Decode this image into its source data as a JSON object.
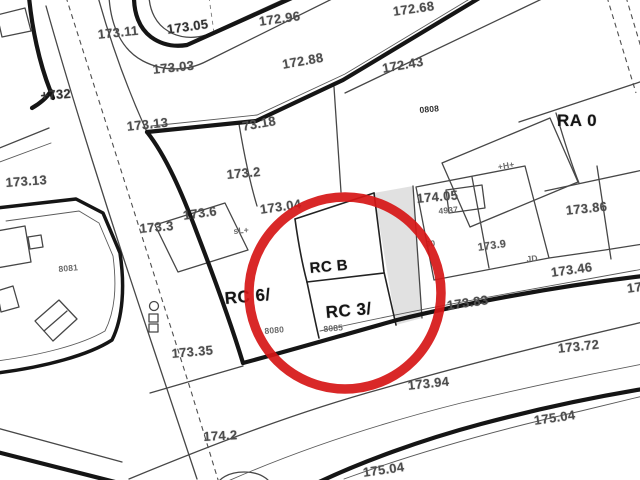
{
  "map": {
    "colors": {
      "background": "#ffffff",
      "thin_lines": "#474747",
      "bold_lines": "#151515",
      "highlight_circle": "#d61616",
      "elevation_text": "#4d4d4d",
      "zone_text": "#141414"
    },
    "highlight": {
      "shape": "circle",
      "cx": 345,
      "cy": 293,
      "r": 96,
      "stroke_width": 9.5
    },
    "zone_codes": [
      "RA 0",
      "RC 6/",
      "RC B",
      "RC 3/"
    ],
    "parcel_numbers": [
      "0808",
      "4937",
      "8080",
      "8081",
      "8085"
    ],
    "labels": [
      {
        "name": "elev-173-11",
        "text": "173.11",
        "x": 97,
        "y": 27,
        "rot": -6,
        "cls": "e"
      },
      {
        "name": "elev-173-05",
        "text": "173.05",
        "x": 166,
        "y": 22,
        "rot": -8,
        "cls": "ed"
      },
      {
        "name": "elev-172-96",
        "text": "172.96",
        "x": 258,
        "y": 14,
        "rot": -8,
        "cls": "e"
      },
      {
        "name": "elev-172-68",
        "text": "172.68",
        "x": 392,
        "y": 4,
        "rot": -8,
        "cls": "e"
      },
      {
        "name": "elev-172-88",
        "text": "172.88",
        "x": 281,
        "y": 57,
        "rot": -10,
        "cls": "e"
      },
      {
        "name": "elev-172-43",
        "text": "172.43",
        "x": 381,
        "y": 61,
        "rot": -10,
        "cls": "e"
      },
      {
        "name": "elev-173-03",
        "text": "173.03",
        "x": 152,
        "y": 62,
        "rot": -6,
        "cls": "e"
      },
      {
        "name": "elev-732",
        "text": "+732",
        "x": 40,
        "y": 88,
        "rot": -4,
        "cls": "ed"
      },
      {
        "name": "elev-173-13-a",
        "text": "173.13",
        "x": 126,
        "y": 119,
        "rot": -6,
        "cls": "e"
      },
      {
        "name": "elev-73-18",
        "text": "73.18",
        "x": 241,
        "y": 119,
        "rot": -10,
        "cls": "e"
      },
      {
        "name": "zone-ra-0",
        "text": "RA 0",
        "x": 557,
        "y": 111,
        "rot": 0,
        "cls": "b"
      },
      {
        "name": "elev-173-13-b",
        "text": "173.13",
        "x": 5,
        "y": 175,
        "rot": -4,
        "cls": "e"
      },
      {
        "name": "elev-173-2",
        "text": "173.2",
        "x": 226,
        "y": 167,
        "rot": -5,
        "cls": "e"
      },
      {
        "name": "elev-173-86",
        "text": "173.86",
        "x": 565,
        "y": 203,
        "rot": -6,
        "cls": "e"
      },
      {
        "name": "elev-174-05",
        "text": "174.05",
        "x": 416,
        "y": 191,
        "rot": -5,
        "cls": "e"
      },
      {
        "name": "parcel-4937",
        "text": "4937",
        "x": 438,
        "y": 206,
        "rot": -5,
        "cls": "t"
      },
      {
        "name": "parcel-0808",
        "text": "0808",
        "x": 419,
        "y": 105,
        "rot": -5,
        "cls": "td"
      },
      {
        "name": "sym-h-marker",
        "text": "+H+",
        "x": 497,
        "y": 162,
        "rot": -10,
        "cls": "t"
      },
      {
        "name": "elev-173-6",
        "text": "173.6",
        "x": 182,
        "y": 208,
        "rot": -8,
        "cls": "e"
      },
      {
        "name": "elev-173-3",
        "text": "173.3",
        "x": 139,
        "y": 221,
        "rot": -5,
        "cls": "e"
      },
      {
        "name": "sym-sl-marker",
        "text": "sL+",
        "x": 233,
        "y": 226,
        "rot": -5,
        "cls": "t"
      },
      {
        "name": "elev-173-04",
        "text": "173.04",
        "x": 259,
        "y": 202,
        "rot": -8,
        "cls": "e"
      },
      {
        "name": "elev-173-9",
        "text": "173.9",
        "x": 477,
        "y": 242,
        "rot": -8,
        "cls": "es"
      },
      {
        "name": "sym-j0-marker",
        "text": "J0",
        "x": 425,
        "y": 239,
        "rot": -5,
        "cls": "t"
      },
      {
        "name": "sym-jd-marker",
        "text": "JD",
        "x": 526,
        "y": 254,
        "rot": -5,
        "cls": "t"
      },
      {
        "name": "elev-173-46",
        "text": "173.46",
        "x": 550,
        "y": 265,
        "rot": -8,
        "cls": "e"
      },
      {
        "name": "elev-17-cut",
        "text": "17",
        "x": 626,
        "y": 281,
        "rot": -8,
        "cls": "e"
      },
      {
        "name": "zone-rc-6",
        "text": "RC 6/",
        "x": 224,
        "y": 289,
        "rot": -5,
        "cls": "b"
      },
      {
        "name": "zone-rc-b",
        "text": "RC B",
        "x": 309,
        "y": 260,
        "rot": -5,
        "cls": "b2"
      },
      {
        "name": "zone-rc-3",
        "text": "RC 3/",
        "x": 325,
        "y": 303,
        "rot": -5,
        "cls": "b"
      },
      {
        "name": "parcel-8085",
        "text": "8085",
        "x": 323,
        "y": 324,
        "rot": -5,
        "cls": "t"
      },
      {
        "name": "parcel-8080",
        "text": "8080",
        "x": 264,
        "y": 326,
        "rot": -5,
        "cls": "t"
      },
      {
        "name": "parcel-8081",
        "text": "8081",
        "x": 58,
        "y": 264,
        "rot": -5,
        "cls": "t"
      },
      {
        "name": "elev-173-35",
        "text": "173.35",
        "x": 171,
        "y": 346,
        "rot": -5,
        "cls": "e"
      },
      {
        "name": "elev-173-83",
        "text": "173.83",
        "x": 446,
        "y": 298,
        "rot": -8,
        "cls": "e"
      },
      {
        "name": "elev-173-72",
        "text": "173.72",
        "x": 557,
        "y": 341,
        "rot": -6,
        "cls": "e"
      },
      {
        "name": "elev-173-94",
        "text": "173.94",
        "x": 407,
        "y": 378,
        "rot": -6,
        "cls": "e"
      },
      {
        "name": "elev-174-2",
        "text": "174.2",
        "x": 203,
        "y": 429,
        "rot": -3,
        "cls": "e"
      },
      {
        "name": "elev-175-04-a",
        "text": "175.04",
        "x": 533,
        "y": 413,
        "rot": -8,
        "cls": "e"
      },
      {
        "name": "elev-175-04-b",
        "text": "175.04",
        "x": 362,
        "y": 465,
        "rot": -8,
        "cls": "e"
      }
    ]
  }
}
